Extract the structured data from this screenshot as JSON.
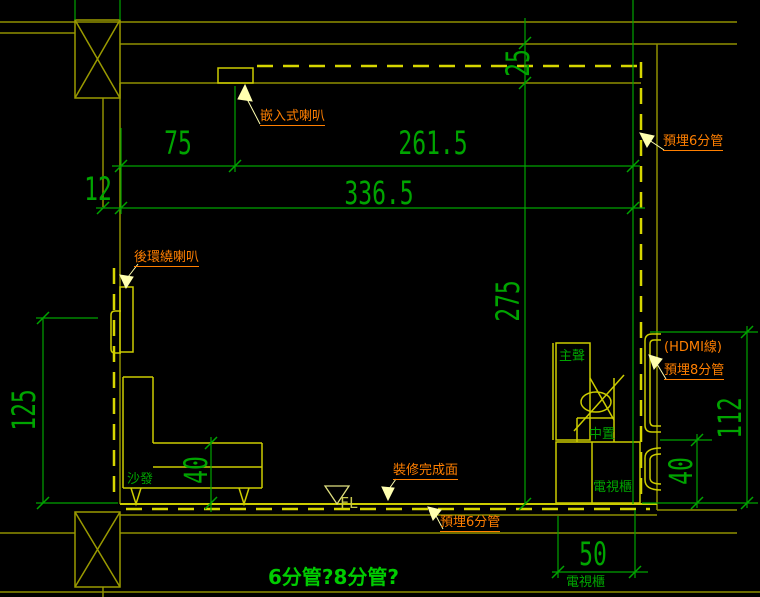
{
  "drawing": {
    "type": "home-theater room section / AV wiring detail",
    "labels": {
      "ceiling_speaker": "嵌入式喇叭",
      "conduit6_top": "預埋6分管",
      "rear_speaker": "後環繞喇叭",
      "hdmi_line": "(HDMI線)",
      "conduit8": "預埋8分管",
      "finish_surface": "裝修完成面",
      "conduit6_bottom": "預埋6分管",
      "sofa": "沙發",
      "main_speaker": "主聲",
      "center_speaker": "中置",
      "tv_cabinet": "電視櫃",
      "tv_cabinet_bottom": "電視櫃",
      "floor_level": "FL",
      "question": "6分管?8分管?"
    },
    "dimensions": {
      "d75": "75",
      "d261_5": "261.5",
      "d336_5": "336.5",
      "d12": "12",
      "d25": "25",
      "d275": "275",
      "d125": "125",
      "d40_sofa": "40",
      "d40_right": "40",
      "d112": "112",
      "d50": "50"
    },
    "colors": {
      "background": "#000000",
      "dimension_green": "#00a400",
      "question_green": "#00cc00",
      "wall_olive": "#8f8f00",
      "object_yellow": "#cccc00",
      "conduit_dash_yellow": "#d6d600",
      "label_orange": "#ff7f00",
      "leader_cream": "#ffffb0"
    }
  }
}
